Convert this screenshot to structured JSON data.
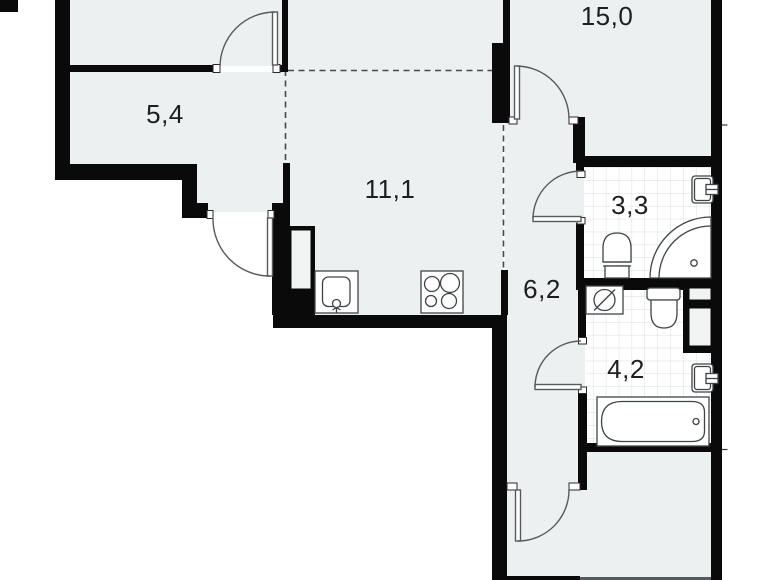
{
  "title": "apartment-floor-plan",
  "rooms": [
    {
      "name": "room-top-left-small",
      "area": "5,4"
    },
    {
      "name": "living-room",
      "area": "15,0"
    },
    {
      "name": "kitchen",
      "area": "11,1"
    },
    {
      "name": "hallway",
      "area": "6,2"
    },
    {
      "name": "bathroom-small",
      "area": "3,3"
    },
    {
      "name": "bathroom-large",
      "area": "4,2"
    }
  ],
  "fixtures": [
    "kitchen-sink",
    "stove-4-burners",
    "toilet",
    "corner-bath",
    "wash-basin",
    "washing-machine",
    "bathtub",
    "ventilation-shaft"
  ],
  "colors": {
    "wall": "#0a0a0a",
    "floor": "#edf0f0",
    "tile_line": "#d8dde0",
    "fixture_outline": "#3f4447",
    "door_arc": "#565a5e",
    "background": "#ffffff"
  }
}
